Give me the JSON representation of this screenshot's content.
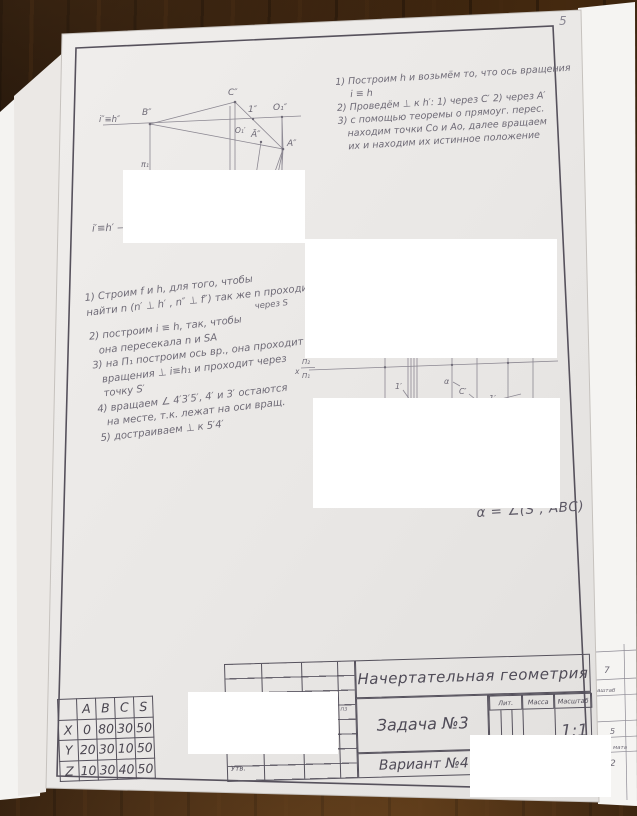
{
  "page": {
    "number": "5"
  },
  "sheet": {
    "subject": "Начертательная геометрия",
    "task": "Задача №3",
    "variant": "Вариант №4",
    "lit_label": "Лит.",
    "mass_label": "Масса",
    "scale_label": "Масштаб",
    "scale_value": "1:1",
    "approved_label": "Утв.",
    "fragment_pz": "пз"
  },
  "notes_top_right": {
    "lines": [
      "1) Построим h и возьмём то, что ось вращения",
      "i ≡ h",
      "2) Проведём ⊥ к h′: 1) через C′ 2) через A′",
      "3) с помощью теоремы о прямоуг. перес.",
      "находим точки Со и Ао, далее вращаем",
      "их и находим их истинное положение"
    ]
  },
  "notes_left": {
    "lines": [
      "1) Строим f и h, для того, чтобы",
      "найти n (n′ ⊥ h′ , n″ ⊥ f″) так же n проходит",
      "через S",
      "2) построим i ≡ h, так, чтобы",
      "она пересекала n и SA",
      "3) на П₁ построим ось вр., она проходит",
      "вращения ⊥ i≡h₁ и проходит через",
      "точку S′",
      "4) вращаем ∠ 4′3′5′, 4′ и 3′ остаются",
      "на месте, т.к. лежат на оси вращ.",
      "5) достраиваем ⊥ к 5′4′"
    ]
  },
  "sketch_front": {
    "labels": {
      "axis": "i″≡h″",
      "B": "B″",
      "C": "C″",
      "p1": "1″",
      "O1": "O₁″",
      "O1s": "O₁′",
      "Abar": "Ā″",
      "A": "A″",
      "pi": "π₁"
    }
  },
  "sketch_horiz_label": "i′≡h′ —",
  "sketch_plan": {
    "labels": {
      "x": "x",
      "p2": "Π₂",
      "p1": "Π₁",
      "n1": "1′",
      "alpha": "α",
      "C": "C′",
      "n2": "1′"
    }
  },
  "formula": "α = ∠(S , ABC)",
  "coords_table": {
    "corner": "",
    "headers": [
      "A",
      "B",
      "C",
      "S"
    ],
    "rows": [
      {
        "label": "X",
        "values": [
          "0",
          "80",
          "30",
          "50"
        ]
      },
      {
        "label": "Y",
        "values": [
          "20",
          "30",
          "10",
          "50"
        ]
      },
      {
        "label": "Z",
        "values": [
          "10",
          "30",
          "40",
          "50"
        ]
      }
    ]
  },
  "backing_strip": {
    "fragments": [
      "7",
      "аштаб",
      "5",
      "мата",
      "2"
    ]
  }
}
